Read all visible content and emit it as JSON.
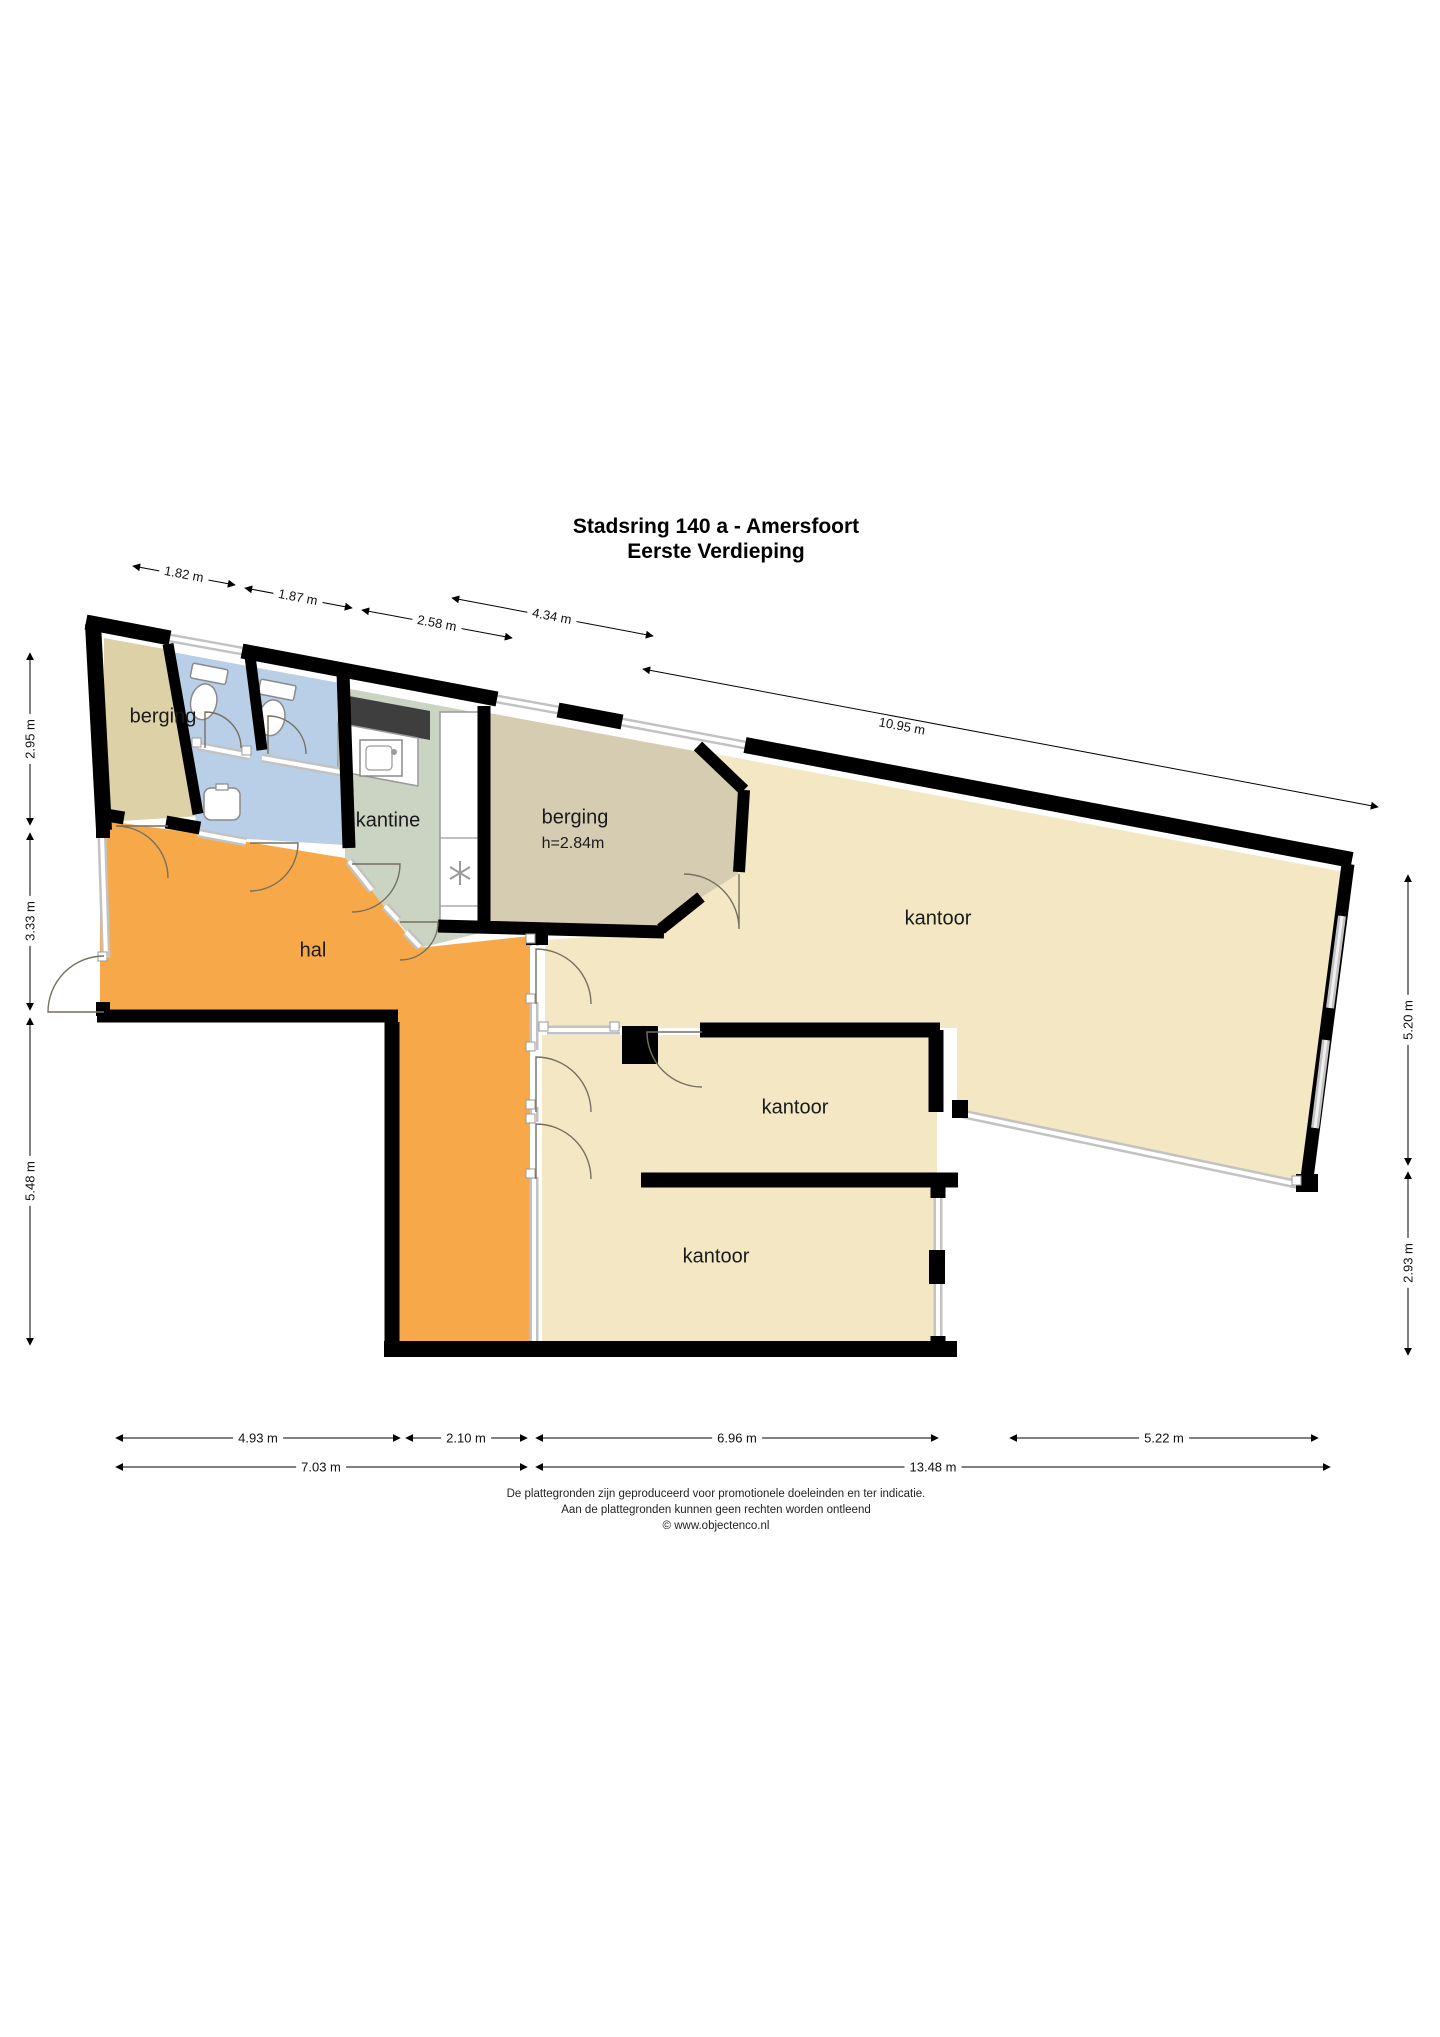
{
  "title": {
    "line1": "Stadsring 140 a - Amersfoort",
    "line2": "Eerste Verdieping"
  },
  "rooms": {
    "berging_1": {
      "label": "berging"
    },
    "kantine": {
      "label": "kantine"
    },
    "berging_2": {
      "label": "berging",
      "height": "h=2.84m"
    },
    "hal": {
      "label": "hal"
    },
    "kantoor_main": {
      "label": "kantoor"
    },
    "kantoor_middle": {
      "label": "kantoor"
    },
    "kantoor_bottom": {
      "label": "kantoor"
    }
  },
  "dimensions": {
    "top": [
      {
        "label": "1.82 m"
      },
      {
        "label": "1.87 m"
      },
      {
        "label": "2.58 m"
      },
      {
        "label": "4.34 m"
      },
      {
        "label": "10.95 m"
      }
    ],
    "left": [
      {
        "label": "2.95 m"
      },
      {
        "label": "3.33 m"
      },
      {
        "label": "5.48 m"
      }
    ],
    "right": [
      {
        "label": "5.20 m"
      },
      {
        "label": "2.93 m"
      }
    ],
    "bottom_upper": [
      {
        "label": "4.93 m"
      },
      {
        "label": "2.10 m"
      },
      {
        "label": "6.96 m"
      },
      {
        "label": "5.22 m"
      }
    ],
    "bottom_lower": [
      {
        "label": "7.03 m"
      },
      {
        "label": "13.48 m"
      }
    ]
  },
  "footer": {
    "line1": "De plattegronden zijn geproduceerd voor promotionele doeleinden en ter indicatie.",
    "line2": "Aan de plattegronden kunnen geen rechten worden ontleend",
    "line3": "© www.objectenco.nl"
  },
  "colors": {
    "wall": "#000000",
    "berging": "#ddd1a8",
    "berging2": "#d6ccb2",
    "sanitair": "#b9cfe7",
    "kantine": "#cbd3c3",
    "hal": "#f7a94a",
    "kantoor": "#f3e8c3",
    "glass": "#c2c2c2",
    "counter_dark": "#3e3e3e"
  }
}
